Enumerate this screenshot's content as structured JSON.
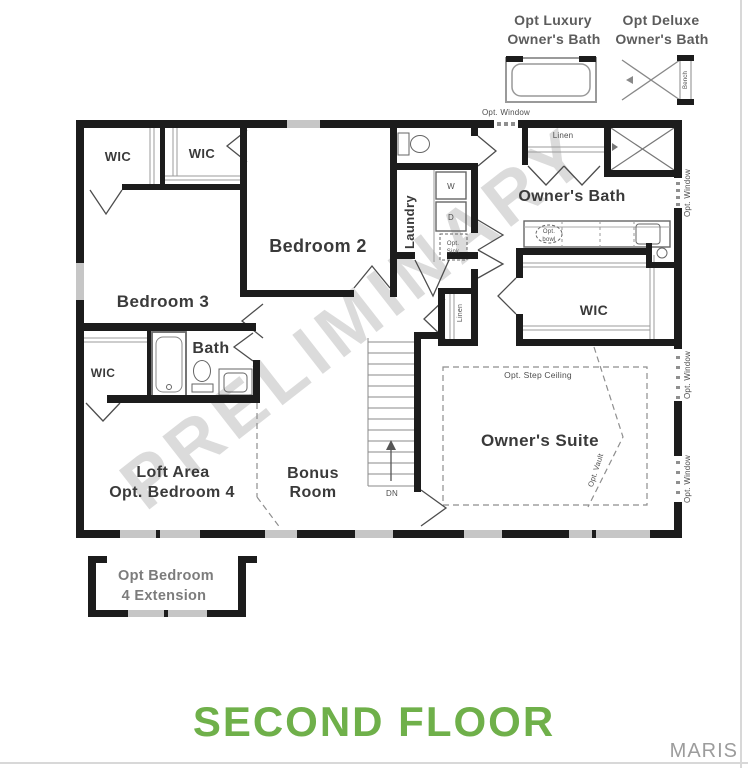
{
  "legend": {
    "luxury": {
      "line1": "Opt Luxury",
      "line2": "Owner's Bath"
    },
    "deluxe": {
      "line1": "Opt Deluxe",
      "line2": "Owner's Bath",
      "bench": "Bench"
    }
  },
  "rooms": {
    "wic": "WIC",
    "bedroom2": "Bedroom 2",
    "bedroom3": "Bedroom 3",
    "laundry": "Laundry",
    "owners_bath": "Owner's Bath",
    "bath": "Bath",
    "loft1": "Loft Area",
    "loft2": "Opt. Bedroom 4",
    "bonus1": "Bonus",
    "bonus2": "Room",
    "owners_suite": "Owner's Suite"
  },
  "annotations": {
    "opt_window": "Opt. Window",
    "linen": "Linen",
    "opt_step_ceiling": "Opt. Step Ceiling",
    "opt_vault": "Opt. Vault",
    "dn": "DN",
    "washer": "W",
    "dryer": "D",
    "opt_sink1": "Opt.",
    "opt_sink2": "Sink",
    "opt_bowl1": "Opt.",
    "opt_bowl2": "bowl",
    "ext1": "Opt Bedroom",
    "ext2": "4 Extension"
  },
  "watermark": "PRELIMINARY",
  "footer": {
    "title": "SECOND FLOOR",
    "brand": "MARIS"
  },
  "colors": {
    "wall": "#1c1c1c",
    "window": "#c6c6c6",
    "title_green": "#6fb04a",
    "watermark_gray": "#c6c6c6",
    "brand_gray": "#9c9c9c"
  }
}
